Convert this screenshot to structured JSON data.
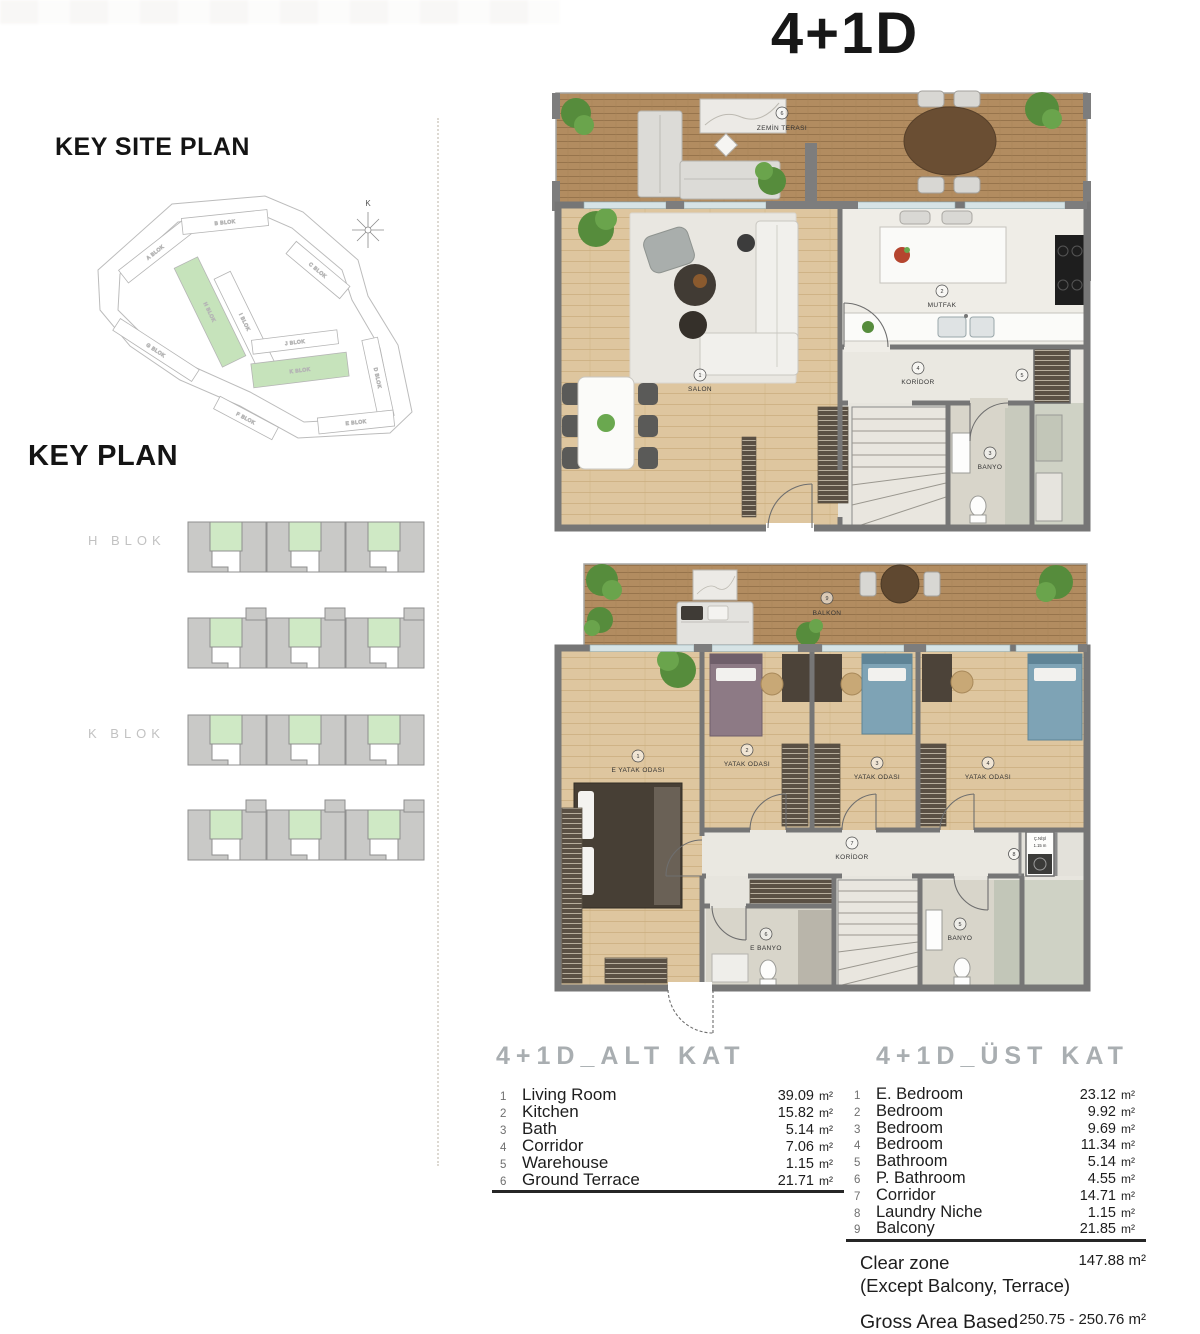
{
  "page": {
    "title": "4+1D"
  },
  "key_site_plan": {
    "heading": "KEY SITE PLAN",
    "compass": "K",
    "blocks": [
      {
        "label": "A BLOK"
      },
      {
        "label": "B BLOK"
      },
      {
        "label": "C BLOK"
      },
      {
        "label": "D BLOK"
      },
      {
        "label": "E BLOK"
      },
      {
        "label": "F BLOK"
      },
      {
        "label": "G BLOK"
      },
      {
        "label": "H BLOK",
        "highlight": true
      },
      {
        "label": "I BLOK"
      },
      {
        "label": "J BLOK"
      },
      {
        "label": "K BLOK",
        "highlight": true
      }
    ]
  },
  "key_plan": {
    "heading": "KEY PLAN",
    "block_labels": [
      "H BLOK",
      "K BLOK"
    ]
  },
  "floor_plans": {
    "lower": {
      "rooms": [
        {
          "num": "1",
          "label": "SALON"
        },
        {
          "num": "2",
          "label": "MUTFAK"
        },
        {
          "num": "3",
          "label": "BANYO"
        },
        {
          "num": "4",
          "label": "KORİDOR"
        },
        {
          "num": "5",
          "label": ""
        },
        {
          "num": "6",
          "label": "ZEMİN TERASI"
        }
      ]
    },
    "upper": {
      "rooms": [
        {
          "num": "1",
          "label": "E YATAK ODASI"
        },
        {
          "num": "2",
          "label": "YATAK ODASI"
        },
        {
          "num": "3",
          "label": "YATAK ODASI"
        },
        {
          "num": "4",
          "label": "YATAK ODASI"
        },
        {
          "num": "5",
          "label": "BANYO"
        },
        {
          "num": "6",
          "label": "E BANYO"
        },
        {
          "num": "7",
          "label": "KORİDOR"
        },
        {
          "num": "8",
          "label": "Ç.NİŞİ",
          "note": "1.15 m"
        },
        {
          "num": "9",
          "label": "BALKON"
        }
      ]
    }
  },
  "tables": {
    "lower": {
      "title": "4+1D_ALT KAT",
      "unit": "m²",
      "rows": [
        {
          "num": "1",
          "label": "Living Room",
          "area": "39.09"
        },
        {
          "num": "2",
          "label": "Kitchen",
          "area": "15.82"
        },
        {
          "num": "3",
          "label": "Bath",
          "area": "5.14"
        },
        {
          "num": "4",
          "label": "Corridor",
          "area": "7.06"
        },
        {
          "num": "5",
          "label": "Warehouse",
          "area": "1.15"
        },
        {
          "num": "6",
          "label": "Ground Terrace",
          "area": "21.71"
        }
      ]
    },
    "upper": {
      "title": "4+1D_ÜST KAT",
      "unit": "m²",
      "rows": [
        {
          "num": "1",
          "label": "E. Bedroom",
          "area": "23.12"
        },
        {
          "num": "2",
          "label": "Bedroom",
          "area": "9.92"
        },
        {
          "num": "3",
          "label": "Bedroom",
          "area": "9.69"
        },
        {
          "num": "4",
          "label": "Bedroom",
          "area": "11.34"
        },
        {
          "num": "5",
          "label": "Bathroom",
          "area": "5.14"
        },
        {
          "num": "6",
          "label": "P. Bathroom",
          "area": "4.55"
        },
        {
          "num": "7",
          "label": "Corridor",
          "area": "14.71"
        },
        {
          "num": "8",
          "label": "Laundry Niche",
          "area": "1.15"
        },
        {
          "num": "9",
          "label": "Balcony",
          "area": "21.85"
        }
      ]
    },
    "summary": {
      "clear_zone_label": "Clear zone",
      "clear_zone_value": "147.88 m²",
      "clear_zone_note": "(Except Balcony, Terrace)",
      "gross_area_label": "Gross Area Based on Sales",
      "gross_area_value": "250.75 - 250.76 m²"
    }
  },
  "colors": {
    "highlight_green": "#cfe9c5",
    "deck_wood": "#b28c60",
    "floor_wood": "#dec69f",
    "wall_gray": "#767676"
  }
}
